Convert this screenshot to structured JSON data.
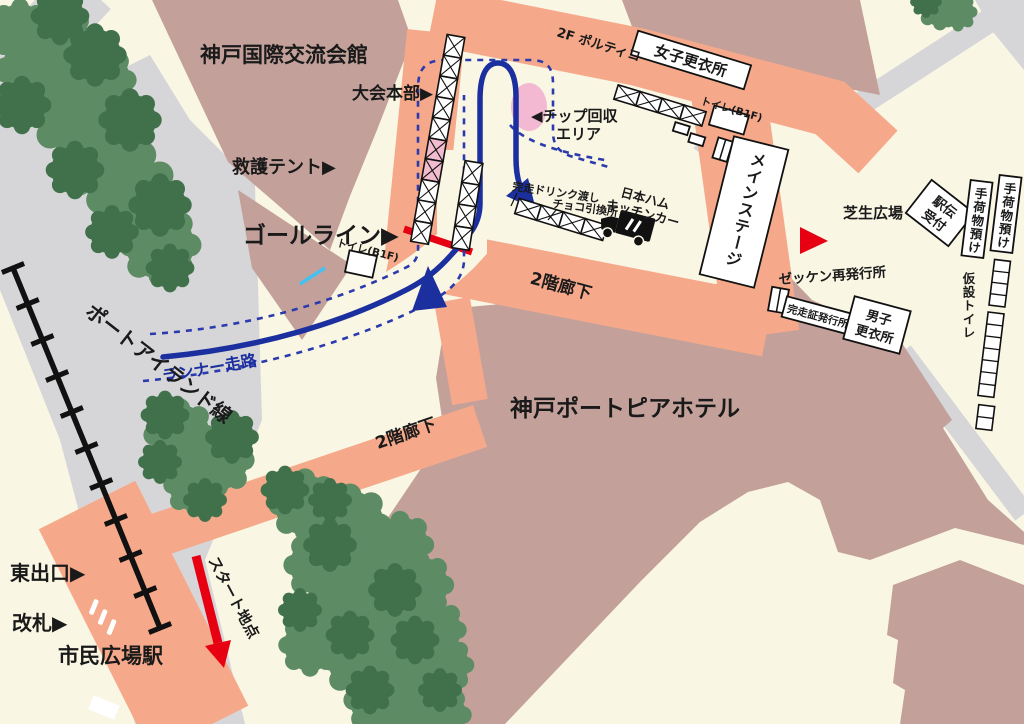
{
  "title": "会場案内マップ",
  "labels": {
    "exchange_hall": "神戸国際交流会館",
    "hq": "大会本部▶",
    "first_aid": "救護テント▶",
    "goal_line": "ゴールライン▶",
    "chip_l1": "◀チップ回収",
    "chip_l2": "エリア",
    "portico": "2F ポルティコ",
    "women_room": "女子更衣所",
    "toilet_b1f_top": "トイレ(B1F)",
    "toilet_b1f_goal": "トイレ(B1F)",
    "drink": "完走ドリンク渡し",
    "choco": "チョコ引換所",
    "kitchen_l1": "日本ハム",
    "kitchen_l2": "キッチンカー",
    "main_stage": "メインステージ",
    "lawn": "芝生広場",
    "ekiden_l1": "駅伝",
    "ekiden_l2": "受付",
    "baggage1": "手荷物預け",
    "baggage2": "手荷物預け",
    "temp_toilet": "仮設トイレ",
    "bib_reissue": "ゼッケン再発行所",
    "cert": "完走証発行所",
    "men_l1": "男子",
    "men_l2": "更衣所",
    "corridor1": "2階廊下",
    "corridor2": "2階廊下",
    "hotel": "神戸ポートピアホテル",
    "runner_course": "ランナー走路",
    "port_line": "ポートアイランド線",
    "east_exit": "東出口▶",
    "gate": "改札▶",
    "station": "市民広場駅",
    "start": "スタート地点"
  },
  "colors": {
    "background": "#FAF6E4",
    "road_gray": "#D6D6D9",
    "walkway_salmon": "#F5A98A",
    "building_mauve": "#C3A19A",
    "tree_light": "#5C8B64",
    "tree_dark": "#41714B",
    "course_blue": "#1B2F9E",
    "dashed_blue": "#2B3AAD",
    "accent_red": "#E60012",
    "chip_pink": "#F3B9D2",
    "tent_pink": "#F2BCCF",
    "cyan_mark": "#44C1F1"
  }
}
